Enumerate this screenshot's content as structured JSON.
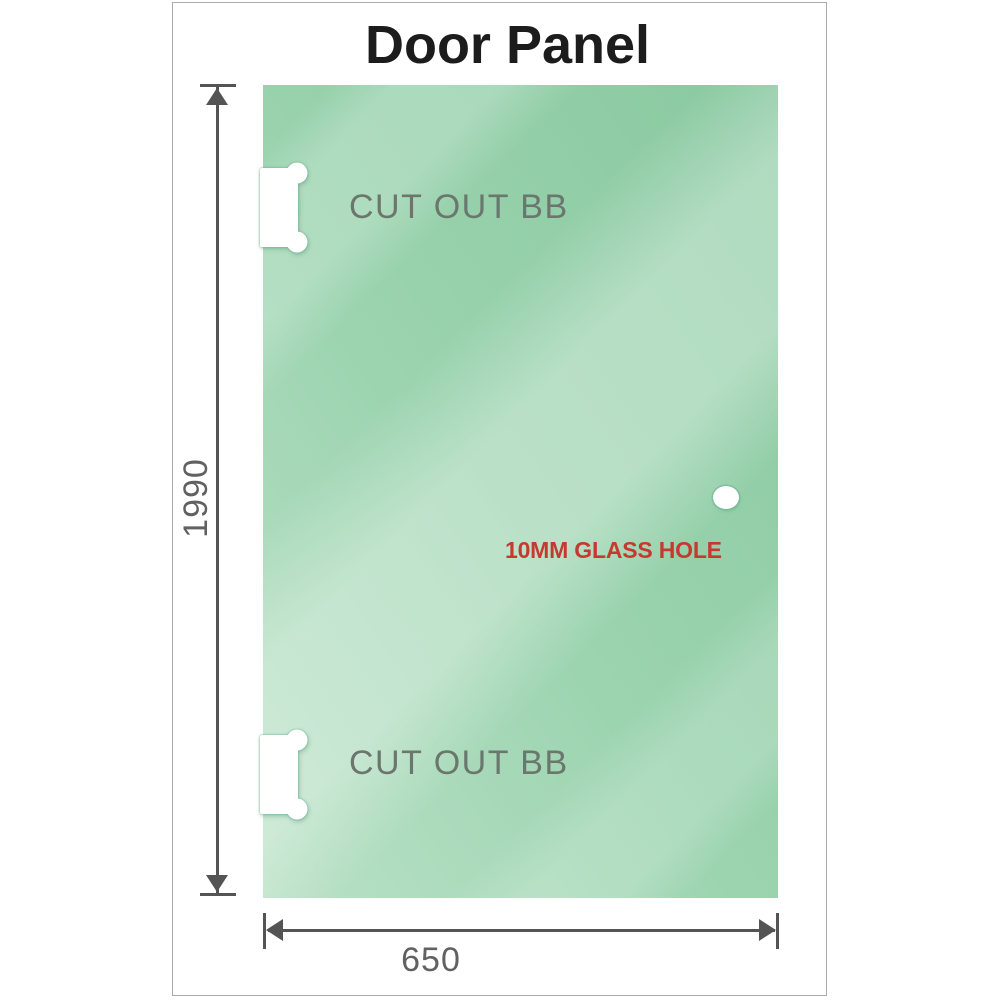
{
  "title": "Door Panel",
  "panel": {
    "cutouts": [
      {
        "position": "top-left",
        "label": "CUT OUT BB"
      },
      {
        "position": "bottom-left",
        "label": "CUT OUT BB"
      }
    ],
    "hole": {
      "label": "10MM GLASS HOLE"
    }
  },
  "dimensions": {
    "height": {
      "value": "1990"
    },
    "width": {
      "value": "650"
    }
  },
  "colors": {
    "glass_base": "#9ad3ae",
    "glass_light": "#b9e1c6",
    "glass_dark": "#8ac9a1",
    "cutout_fill": "#ffffff",
    "label_gray": "#6b766d",
    "dimension_gray": "#545454",
    "dim_text_gray": "#616161",
    "annotation_red": "#c63931",
    "frame_border": "#ababab",
    "title_color": "#1c1c1c"
  }
}
